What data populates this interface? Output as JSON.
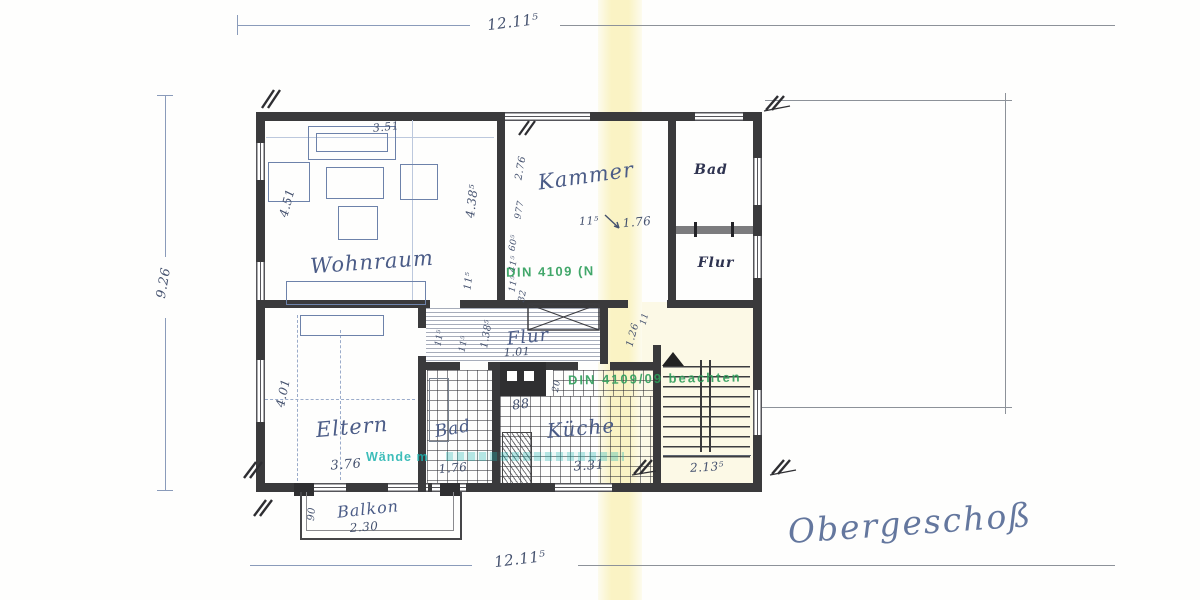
{
  "title": {
    "text": "Obergeschoß"
  },
  "rooms": {
    "wohnraum": "Wohnraum",
    "kammer": "Kammer",
    "bad_top": "Bad",
    "flur_top": "Flur",
    "flur_mid": "Flur",
    "eltern": "Eltern",
    "bad_bottom": "Bad",
    "kueche": "Küche",
    "balkon": "Balkon"
  },
  "dims": {
    "overall_width_top": "12.11⁵",
    "overall_width_bottom": "12.11⁵",
    "overall_depth_left": "9.26",
    "sofa_width": "3.51",
    "wohnraum_depth": "4.51",
    "wohnraum_right_depth": "4.38⁵",
    "wall_11a": "11⁵",
    "chain_276": "2.76",
    "chain_977": "977",
    "chain_60": "60⁵",
    "chain_41": "41⁵",
    "chain_11b": "11⁵",
    "chain_32": "32",
    "kammer_wall": "11⁵",
    "kammer_door": "1.76",
    "flur_width": "1.01",
    "flur_depth": "1.38⁵",
    "flur_11": "11⁵",
    "eltern_door_11": "11⁵",
    "corridor_126": "1.26",
    "corridor_11": "11",
    "shaft_88": "88",
    "door_20": "20",
    "eltern_depth": "4.01",
    "eltern_width": "3.76",
    "bad_width": "1.76",
    "kueche_width": "3.31",
    "treppe_width": "2.13⁵",
    "balkon_width": "2.30",
    "balkon_depth": "90"
  },
  "stamps": {
    "din_upper": "DIN 4109 (N",
    "din_lower": "DIN 4109/09 beachten",
    "walls_note": "Wände m"
  },
  "colors": {
    "wall": "#3a3a3c",
    "pencil_blue": "#4b5c87",
    "stamp_green": "#2e9e5b",
    "stamp_teal": "#1cb2ae",
    "fold_highlight": "#f5e796"
  }
}
